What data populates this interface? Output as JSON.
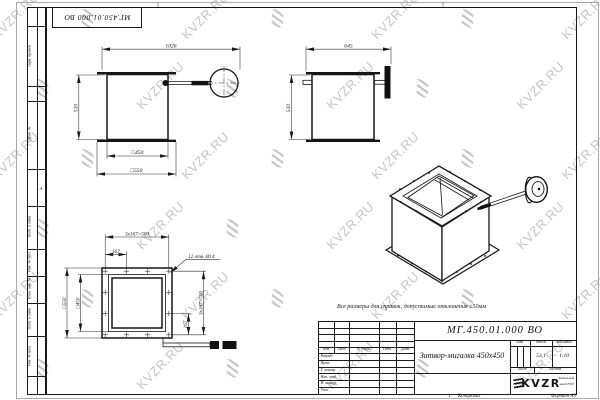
{
  "watermark": {
    "text": "KVZR.RU",
    "color": "#c6c6c6"
  },
  "stamp": {
    "doc_number_rotated": "МГ.450.01.000 ВО"
  },
  "margin_labels": {
    "perv_primen": "Перв. примен.",
    "sprav_no": "Справ. №",
    "podp_data": "Подп. и дата",
    "inv_dubl": "Инв. № дубл.",
    "vzam_inv": "Взам. инв. №",
    "inv_podl": "Инв. № подл.",
    "zone": "А"
  },
  "note": "Все размеры для справок, допустимые отклонения ±50мм",
  "views": {
    "front": {
      "dim_total_width": "1026",
      "dim_height": "510",
      "dim_inner": "□450",
      "dim_outer": "□550"
    },
    "side": {
      "dim_width": "645",
      "dim_height": "510"
    },
    "flange": {
      "dim_pitch_top": "3x167=500",
      "dim_offset_top": "167",
      "dim_holes": "12 отв. Ø14",
      "dim_outer": "□550",
      "dim_inner": "□450",
      "dim_pitch_right": "3x167=500",
      "dim_offset_right": "167"
    }
  },
  "title_block": {
    "doc_number": "МГ.450.01.000 ВО",
    "name": "Затвор-мигалка 450x450",
    "mass_value": "53,1",
    "scale_value": "1:10",
    "headers": {
      "izm": "Изм.",
      "list": "Лист",
      "doc": "№ докум.",
      "podp": "Подп.",
      "data": "Дата",
      "lit": "Лит.",
      "mass": "Масса",
      "scale": "Масштаб",
      "sheet": "Лист",
      "sheets": "Листов"
    },
    "sign_rows": [
      "Разраб.",
      "Пров.",
      "Т. контр.",
      "Нач. отд.",
      "Н. контр.",
      "Утв."
    ],
    "logo": {
      "brand": "KVZR",
      "company_line1": "Котельный",
      "company_line2": "завод РЭП"
    }
  },
  "footer": {
    "sheet_num": "1",
    "copied": "Копировал",
    "format": "Формат А3"
  }
}
